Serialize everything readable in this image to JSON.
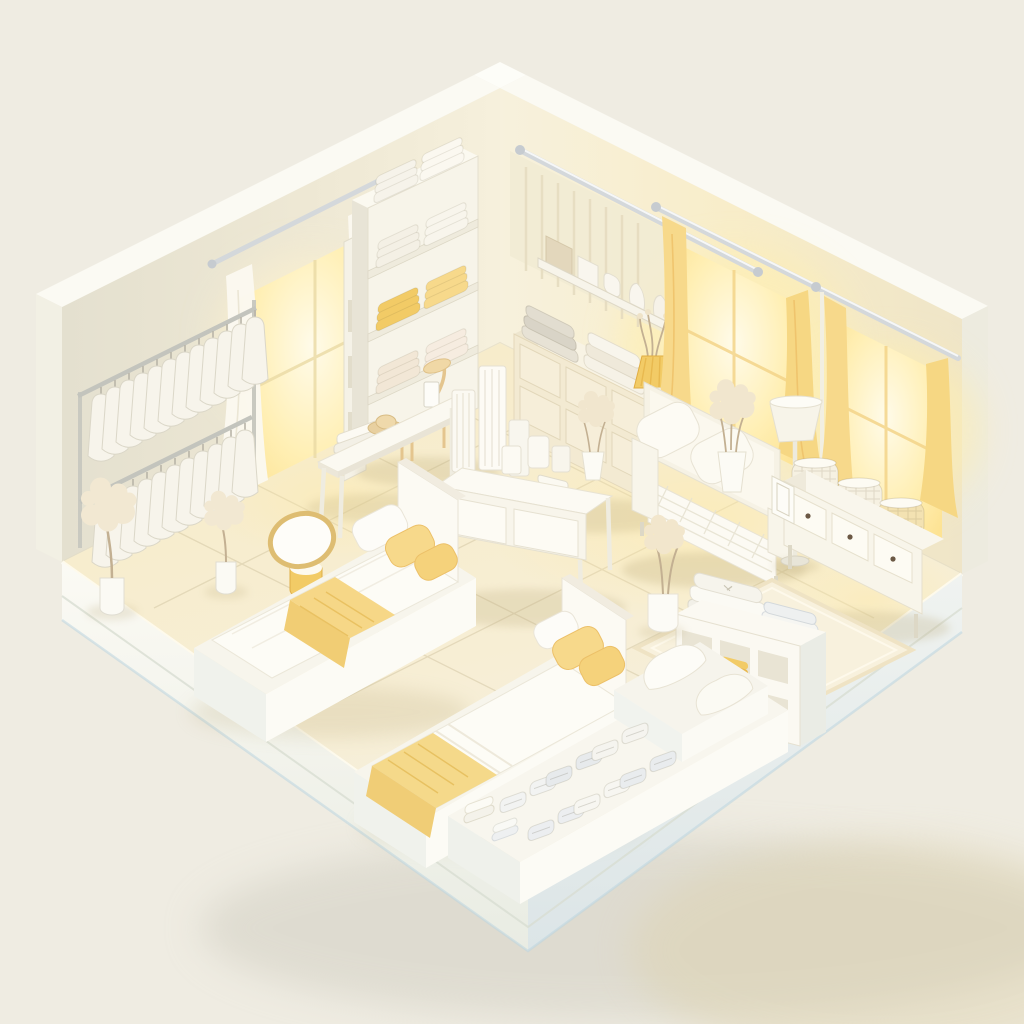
{
  "scene": {
    "label": "Isometric 3D render of a white and pale-yellow bedding showroom in an open-corner room",
    "style": "soft minimal 3D render",
    "room": {
      "walls": 2,
      "windows_left_wall": 1,
      "windows_right_wall": 2,
      "floor": "cream ceramic tiles on a white display plinth"
    },
    "objects": [
      {
        "name": "clothing-rack",
        "tiers": 2,
        "garments_upper": 12,
        "garments_lower": 11,
        "garment_color": "white"
      },
      {
        "name": "left-window",
        "curtains": "white sheer"
      },
      {
        "name": "shelving-unit",
        "shelves": 4,
        "towel_stacks": {
          "white": 4,
          "yellow": 2,
          "cream": 2
        }
      },
      {
        "name": "cubby-tower",
        "cubbies": 3
      },
      {
        "name": "wall-rail",
        "material": "silver metal"
      },
      {
        "name": "wall-shelf",
        "items": [
          "tan box",
          "white boxes",
          "paper bags"
        ]
      },
      {
        "name": "dresser",
        "drawer_rows": 2,
        "top_items": [
          "grey linen stack",
          "white linen stack",
          "yellow pleated lamp",
          "dried sprigs"
        ]
      },
      {
        "name": "right-window-1",
        "curtains": "glowing yellow"
      },
      {
        "name": "right-window-2",
        "curtains": "glowing yellow"
      },
      {
        "name": "sofa",
        "pillows": 2,
        "finish": "white woven"
      },
      {
        "name": "floor-lamp",
        "shade": "white cone"
      },
      {
        "name": "console-bench",
        "drawers": 3,
        "baskets": 3,
        "extra": "leaning picture frame"
      },
      {
        "name": "display-table",
        "boxes": 8,
        "extra": "vase with dried flowers"
      },
      {
        "name": "long-table",
        "items": [
          "folded linens",
          "straw hat",
          "standing card"
        ],
        "chair": "light wood"
      },
      {
        "name": "bed-1",
        "bedding": "white dotted duvet, yellow throw, 1 white + 2 yellow pillows"
      },
      {
        "name": "bed-2",
        "bedding": "white duvet, yellow foot blanket, 2 yellow pillows"
      },
      {
        "name": "round-stool-mirror",
        "trim": "gold"
      },
      {
        "name": "cube-storage",
        "cubbies": 6,
        "contents": [
          "white towels",
          "yellow towels",
          "striped towels"
        ]
      },
      {
        "name": "area-rug",
        "color": "pale cream weave"
      },
      {
        "name": "display-platform",
        "rows_of_folded_towels": 6,
        "pillows": 2
      },
      {
        "name": "potted-plants",
        "count": 5,
        "type": "white blossom / dried sprigs"
      }
    ]
  },
  "palette": {
    "bg": "#efece2",
    "bg_shadow": "#cfccc0",
    "bg_shadow_warm": "#ddd0a8",
    "wall_left_a": "#e6e2d0",
    "wall_left_b": "#f5efdb",
    "wall_right_a": "#f7f0dc",
    "wall_right_b": "#eee4c8",
    "wall_rim": "#fbfaf3",
    "wall_cap": "#f2f0e4",
    "floor_a": "#f9efcc",
    "floor_b": "#f5efdf",
    "tile_line": "#c9bb96",
    "plinth_a": "#fbfaf4",
    "plinth_b": "#e9ece4",
    "plinth_r_a": "#eff2ef",
    "plinth_r_b": "#dde6e8",
    "plinth_blue": "#bcd5e0",
    "white_hi": "#fcfbf5",
    "white_lo": "#efece0",
    "white_cool": "#eaece5",
    "edge": "#e1dccb",
    "accent_yellow": "#f2cb66",
    "yellow_soft": "#f7d98b",
    "yellow_deep": "#e9b94f",
    "window_glow": "#ffeea8",
    "window_bright": "#fffbe8",
    "curtain_white": "#fbf8ef",
    "wood": "#e4c58e",
    "hat": "#e8d0a0",
    "knob": "#6b5844",
    "linen_grey": "#d9d4c7",
    "basket": "#f6f1e2",
    "basket_glow": "#f3e2b2",
    "plant": "#f2e8d2",
    "stem": "#c3b092",
    "metal": "#d4d8db",
    "shadow_warm": "#b9a878"
  }
}
